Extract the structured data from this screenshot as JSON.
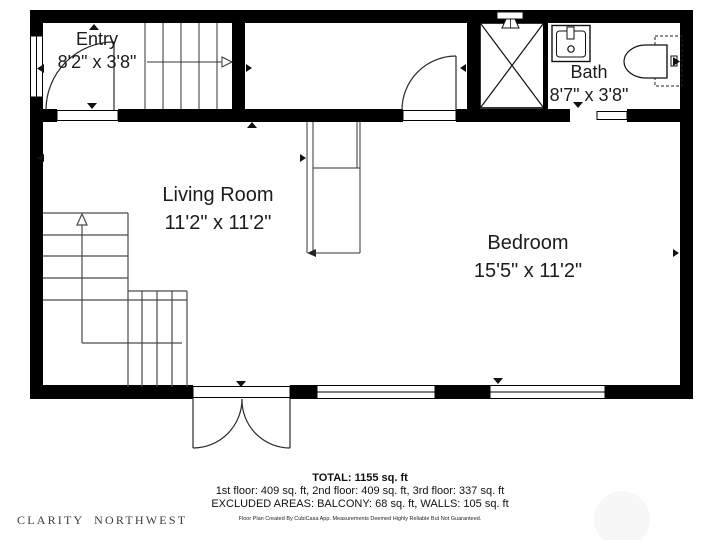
{
  "floor_plan": {
    "rooms": [
      {
        "name": "Entry",
        "dimensions": "8'2\" x 3'8\""
      },
      {
        "name": "Bath",
        "dimensions": "8'7\" x 3'8\""
      },
      {
        "name": "Living Room",
        "dimensions": "11'2\" x 11'2\""
      },
      {
        "name": "Bedroom",
        "dimensions": "15'5\" x 11'2\""
      }
    ],
    "fixtures": [
      "shower",
      "sink",
      "toilet",
      "staircase-up",
      "staircase-down",
      "entry-door",
      "hall-door",
      "french-doors",
      "windows"
    ]
  },
  "summary": {
    "total": "TOTAL: 1155 sq. ft",
    "floors": "1st floor: 409 sq. ft, 2nd floor: 409 sq. ft, 3rd floor: 337 sq. ft",
    "excluded": "EXCLUDED AREAS: BALCONY: 68 sq. ft, WALLS: 105 sq. ft",
    "disclaimer": "Floor Plan Created By CubiCasa App. Measurements Deemed Highly Reliable But Not Guaranteed."
  },
  "branding": {
    "logo_text": "CLARITY NORTHWEST"
  },
  "colors": {
    "wall": "#000000",
    "stair_line": "#4a4a4a",
    "text": "#1c1c1c",
    "background": "#ffffff"
  }
}
